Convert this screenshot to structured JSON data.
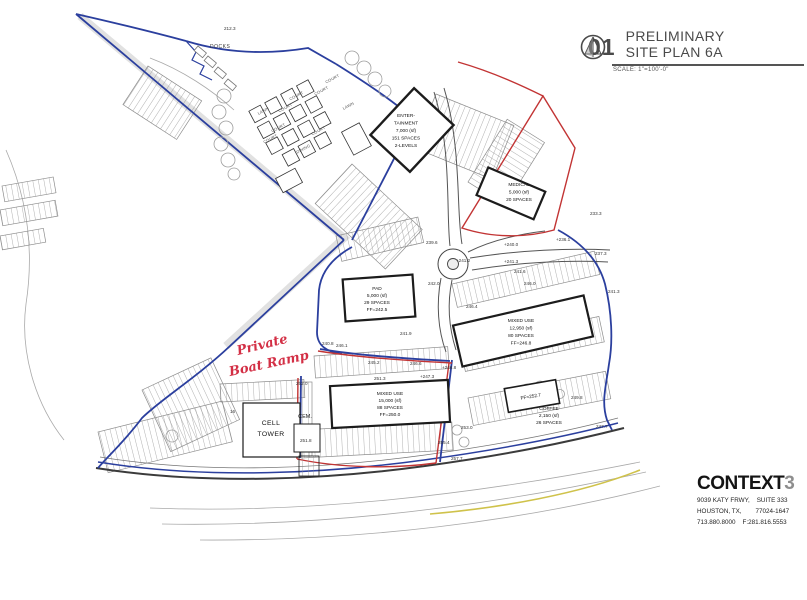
{
  "title_block": {
    "sheet_number": "01",
    "line1": "PRELIMINARY",
    "line2": "SITE PLAN 6A",
    "scale": "SCALE: 1\"=100'-0\""
  },
  "firm": {
    "name": "CONTEXT",
    "name_digit": "3",
    "address1": "9039 KATY FRWY,    SUITE 333",
    "address2": "HOUSTON, TX,        77024-1647",
    "address3": "713.880.8000    F:281.816.5553"
  },
  "colors": {
    "boundary_blue": "#2b3f9e",
    "parcel_red": "#c23434",
    "handwriting_red": "#d32f45",
    "road_yellow": "#cfc24a"
  },
  "plan_blocks": [
    {
      "name": "entertainment-label",
      "x": 406,
      "y": 117,
      "lh": 7.5,
      "cls": "bldg",
      "lines": [
        "ENTER-",
        "TAINMENT",
        "7,000 (sf)",
        "151 SPACES",
        "2-LEVELS"
      ]
    },
    {
      "name": "medical-label",
      "x": 519,
      "y": 186,
      "lh": 7.5,
      "cls": "bldg",
      "lines": [
        "MEDICAL",
        "5,000 (sf)",
        "20 SPACES"
      ]
    },
    {
      "name": "pad-label",
      "x": 377,
      "y": 290,
      "lh": 7,
      "cls": "bldg",
      "lines": [
        "PAD",
        "5,000 (sf)",
        "29 SPACES",
        "FF=242.5"
      ]
    },
    {
      "name": "mixed-use-east-label",
      "x": 521,
      "y": 322,
      "lh": 7.5,
      "cls": "bldg",
      "lines": [
        "MIXED USE",
        "12,950 (sf)",
        "80 SPACES",
        "FF=246.8"
      ]
    },
    {
      "name": "mixed-use-south-label",
      "x": 390,
      "y": 395,
      "lh": 7,
      "cls": "bldg",
      "lines": [
        "MIXED USE",
        "15,000 (sf)",
        "88 SPACES",
        "FF=250.0"
      ]
    },
    {
      "name": "coffee-label",
      "x": 549,
      "y": 410,
      "lh": 7,
      "cls": "bldg",
      "lines": [
        "COFFEE",
        "2,150 (sf)",
        "26 SPACES"
      ]
    },
    {
      "name": "coffee-ff-label",
      "x": 531,
      "y": 398,
      "lh": 7,
      "cls": "bldg",
      "rot": -10,
      "lines": [
        "FF=252.7"
      ]
    },
    {
      "name": "cell-tower-label",
      "x": 271,
      "y": 425,
      "lh": 11,
      "cls": "bldg-lg",
      "lines": [
        "CELL",
        "TOWER"
      ]
    },
    {
      "name": "cemetery-label",
      "x": 305,
      "y": 418,
      "lh": 7,
      "cls": "bldg-md",
      "lines": [
        "CEM."
      ]
    }
  ],
  "plan_texts": [
    {
      "t": "212.3",
      "x": 224,
      "y": 30,
      "name": "spot-elevation"
    },
    {
      "t": "DOCKS",
      "x": 210,
      "y": 48,
      "cls": "t-site",
      "name": "docks-label"
    },
    {
      "t": "233.3",
      "x": 590,
      "y": 215,
      "name": "spot-elevation"
    },
    {
      "t": "+236.1",
      "x": 556,
      "y": 241,
      "name": "spot-elevation"
    },
    {
      "t": "237.3",
      "x": 595,
      "y": 255,
      "name": "spot-elevation"
    },
    {
      "t": "241.3",
      "x": 608,
      "y": 293,
      "name": "spot-elevation"
    },
    {
      "t": "239.6",
      "x": 426,
      "y": 244,
      "name": "spot-elevation"
    },
    {
      "t": "+240.0",
      "x": 504,
      "y": 246,
      "name": "spot-elevation"
    },
    {
      "t": "+241.2",
      "x": 456,
      "y": 262,
      "name": "spot-elevation"
    },
    {
      "t": "+241.3",
      "x": 504,
      "y": 263,
      "name": "spot-elevation"
    },
    {
      "t": "241.6",
      "x": 514,
      "y": 273,
      "name": "spot-elevation"
    },
    {
      "t": "242.0",
      "x": 428,
      "y": 285,
      "name": "spot-elevation"
    },
    {
      "t": "246.0",
      "x": 524,
      "y": 285,
      "name": "spot-elevation"
    },
    {
      "t": "246.4",
      "x": 466,
      "y": 308,
      "name": "spot-elevation"
    },
    {
      "t": "246.1",
      "x": 336,
      "y": 347,
      "name": "spot-elevation"
    },
    {
      "t": "241.9",
      "x": 400,
      "y": 335,
      "name": "spot-elevation"
    },
    {
      "t": "240.8",
      "x": 322,
      "y": 345,
      "name": "spot-elevation"
    },
    {
      "t": "245.2",
      "x": 368,
      "y": 364,
      "name": "spot-elevation"
    },
    {
      "t": "246.6",
      "x": 410,
      "y": 365,
      "name": "spot-elevation"
    },
    {
      "t": "+246.8",
      "x": 442,
      "y": 369,
      "name": "spot-elevation"
    },
    {
      "t": "+247.3",
      "x": 420,
      "y": 378,
      "name": "spot-elevation"
    },
    {
      "t": "251.3",
      "x": 374,
      "y": 380,
      "name": "spot-elevation"
    },
    {
      "t": "252.0",
      "x": 296,
      "y": 385,
      "name": "spot-elevation"
    },
    {
      "t": "251.8",
      "x": 300,
      "y": 442,
      "name": "spot-elevation"
    },
    {
      "t": "253.0",
      "x": 461,
      "y": 429,
      "name": "spot-elevation"
    },
    {
      "t": "255.4",
      "x": 438,
      "y": 444,
      "name": "spot-elevation"
    },
    {
      "t": "257.7",
      "x": 451,
      "y": 460,
      "name": "spot-elevation"
    },
    {
      "t": "247.7",
      "x": 596,
      "y": 428,
      "name": "spot-elevation"
    },
    {
      "t": "249.8",
      "x": 571,
      "y": 399,
      "name": "spot-elevation"
    },
    {
      "t": "16",
      "x": 230,
      "y": 413,
      "name": "parking-count"
    },
    {
      "t": "COURT",
      "x": 333,
      "y": 80,
      "cls": "t-court",
      "rot": -28,
      "name": "court-label"
    },
    {
      "t": "COURT",
      "x": 322,
      "y": 92,
      "cls": "t-court",
      "rot": -28,
      "name": "court-label"
    },
    {
      "t": "COURT",
      "x": 297,
      "y": 97,
      "cls": "t-court",
      "rot": -28,
      "name": "court-label"
    },
    {
      "t": "COURT",
      "x": 286,
      "y": 109,
      "cls": "t-court",
      "rot": -28,
      "name": "court-label"
    },
    {
      "t": "COURT",
      "x": 279,
      "y": 129,
      "cls": "t-court",
      "rot": -28,
      "name": "court-label"
    },
    {
      "t": "COURT",
      "x": 271,
      "y": 140,
      "cls": "t-court",
      "rot": -28,
      "name": "court-label"
    },
    {
      "t": "COURT",
      "x": 319,
      "y": 132,
      "cls": "t-court",
      "rot": -28,
      "name": "court-label"
    },
    {
      "t": "LAWN",
      "x": 264,
      "y": 112,
      "cls": "t-court",
      "rot": -28,
      "name": "lawn-label"
    },
    {
      "t": "LAWN",
      "x": 349,
      "y": 107,
      "cls": "t-court",
      "rot": -28,
      "name": "lawn-label"
    },
    {
      "t": "DINING",
      "x": 304,
      "y": 150,
      "cls": "t-court",
      "rot": -28,
      "name": "dining-label"
    },
    {
      "t": "Private",
      "x": 238,
      "y": 355,
      "cls": "t-hand",
      "rot": -14,
      "name": "handwritten-note-line1"
    },
    {
      "t": "Boat Ramp",
      "x": 230,
      "y": 376,
      "cls": "t-hand",
      "rot": -12,
      "name": "handwritten-note-line2"
    }
  ]
}
